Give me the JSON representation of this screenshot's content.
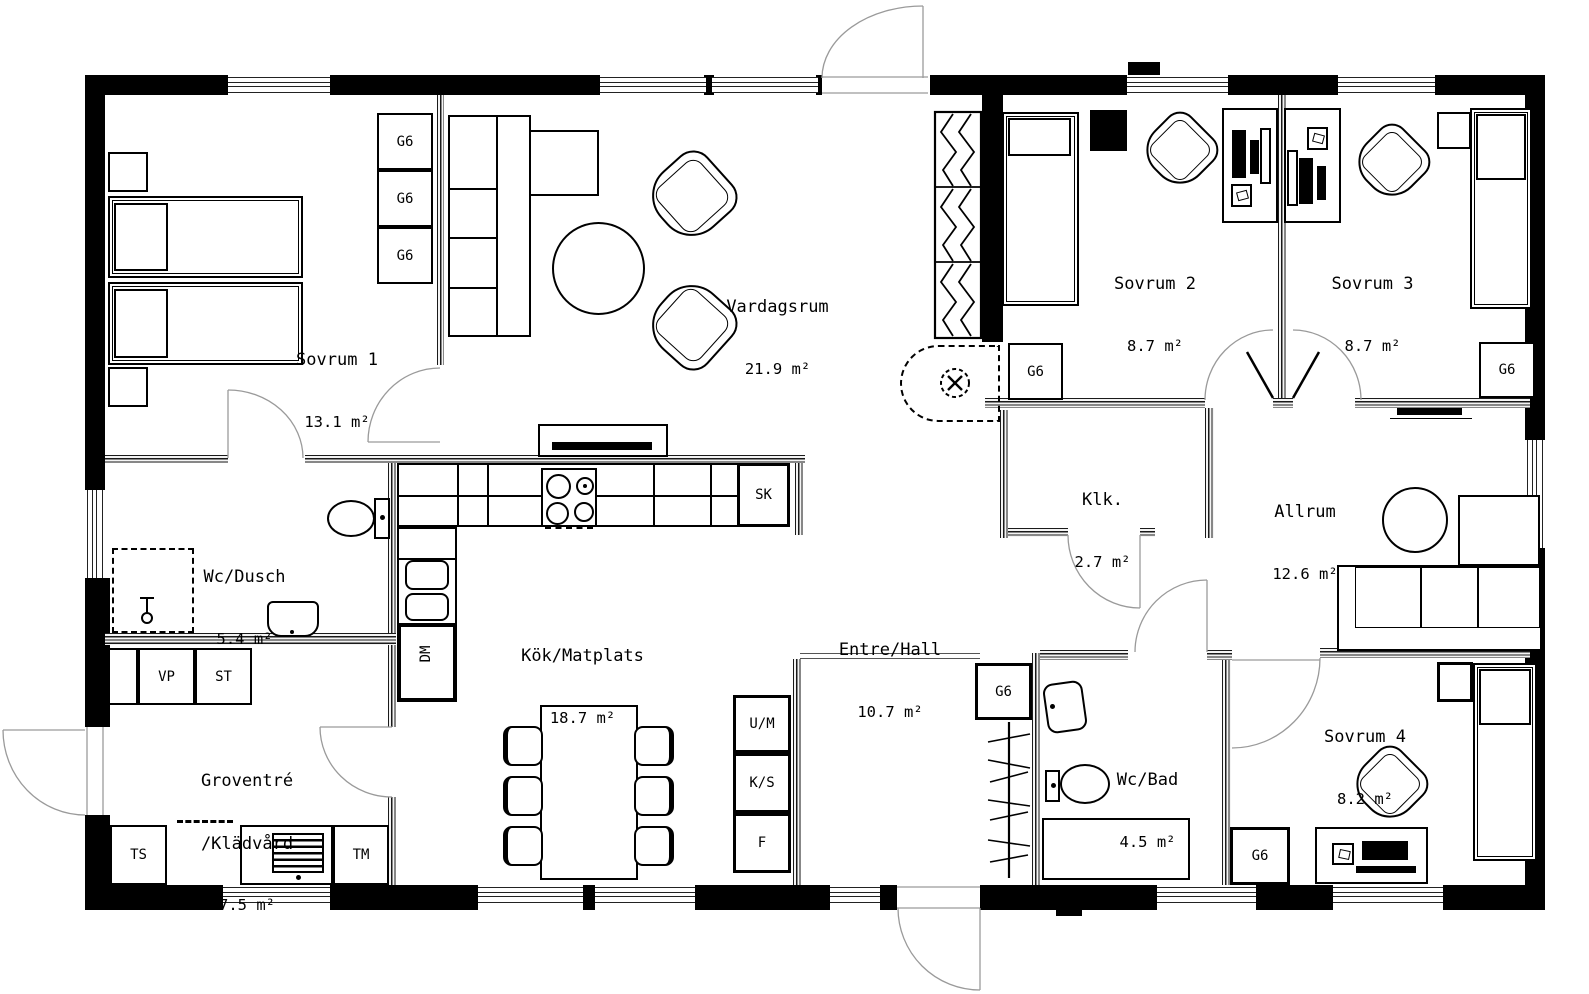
{
  "plan_title": "Floor plan",
  "rooms": [
    {
      "name": "Sovrum 1",
      "area": "13.1 m²"
    },
    {
      "name": "Vardagsrum",
      "area": "21.9 m²"
    },
    {
      "name": "Sovrum 2",
      "area": "8.7 m²"
    },
    {
      "name": "Sovrum 3",
      "area": "8.7 m²"
    },
    {
      "name": "Klk.",
      "area": "2.7 m²"
    },
    {
      "name": "Allrum",
      "area": "12.6 m²"
    },
    {
      "name": "Wc/Dusch",
      "area": "5.4 m²"
    },
    {
      "name": "Kök/Matplats",
      "area": "18.7 m²"
    },
    {
      "name": "Entre/Hall",
      "area": "10.7 m²"
    },
    {
      "name": "Wc/Bad",
      "area": "4.5 m²"
    },
    {
      "name": "Sovrum 4",
      "area": "8.2 m²"
    },
    {
      "name": "Groventré",
      "name_line2": "/Klädvård",
      "area": "7.5 m²"
    }
  ],
  "fixtures": {
    "wardrobe": "G6",
    "tall_cabinet": "SK",
    "dishwasher": "DM",
    "heat_pump": "VP",
    "cleaning_cabinet": "ST",
    "drying_cabinet": "TS",
    "washing_machine": "TM",
    "oven_micro": "U/M",
    "fridge": "K/S",
    "freezer": "F"
  }
}
